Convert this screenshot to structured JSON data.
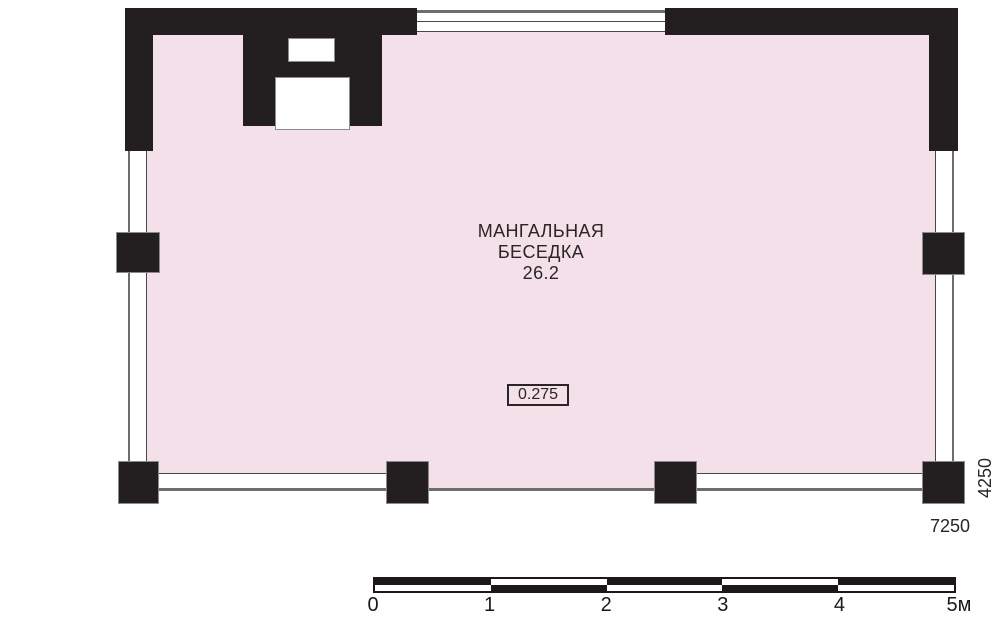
{
  "room": {
    "name_line1": "МАНГАЛЬНАЯ",
    "name_line2": "БЕСЕДКА",
    "area": "26.2",
    "elevation_mark": "0.275"
  },
  "dimensions": {
    "width_mm": "7250",
    "height_mm": "4250"
  },
  "scale_bar": {
    "unit_labels": [
      "0",
      "1",
      "2",
      "3",
      "4",
      "5м"
    ]
  },
  "colors": {
    "floor_fill": "#f3e0e8",
    "wall_black": "#231f20",
    "outline_gray": "#8c8a8a",
    "line_thin": "#4a4747",
    "line_thick": "#6e6c6c",
    "text_dark": "#2b2526",
    "scalebar_black": "#1c1819"
  }
}
